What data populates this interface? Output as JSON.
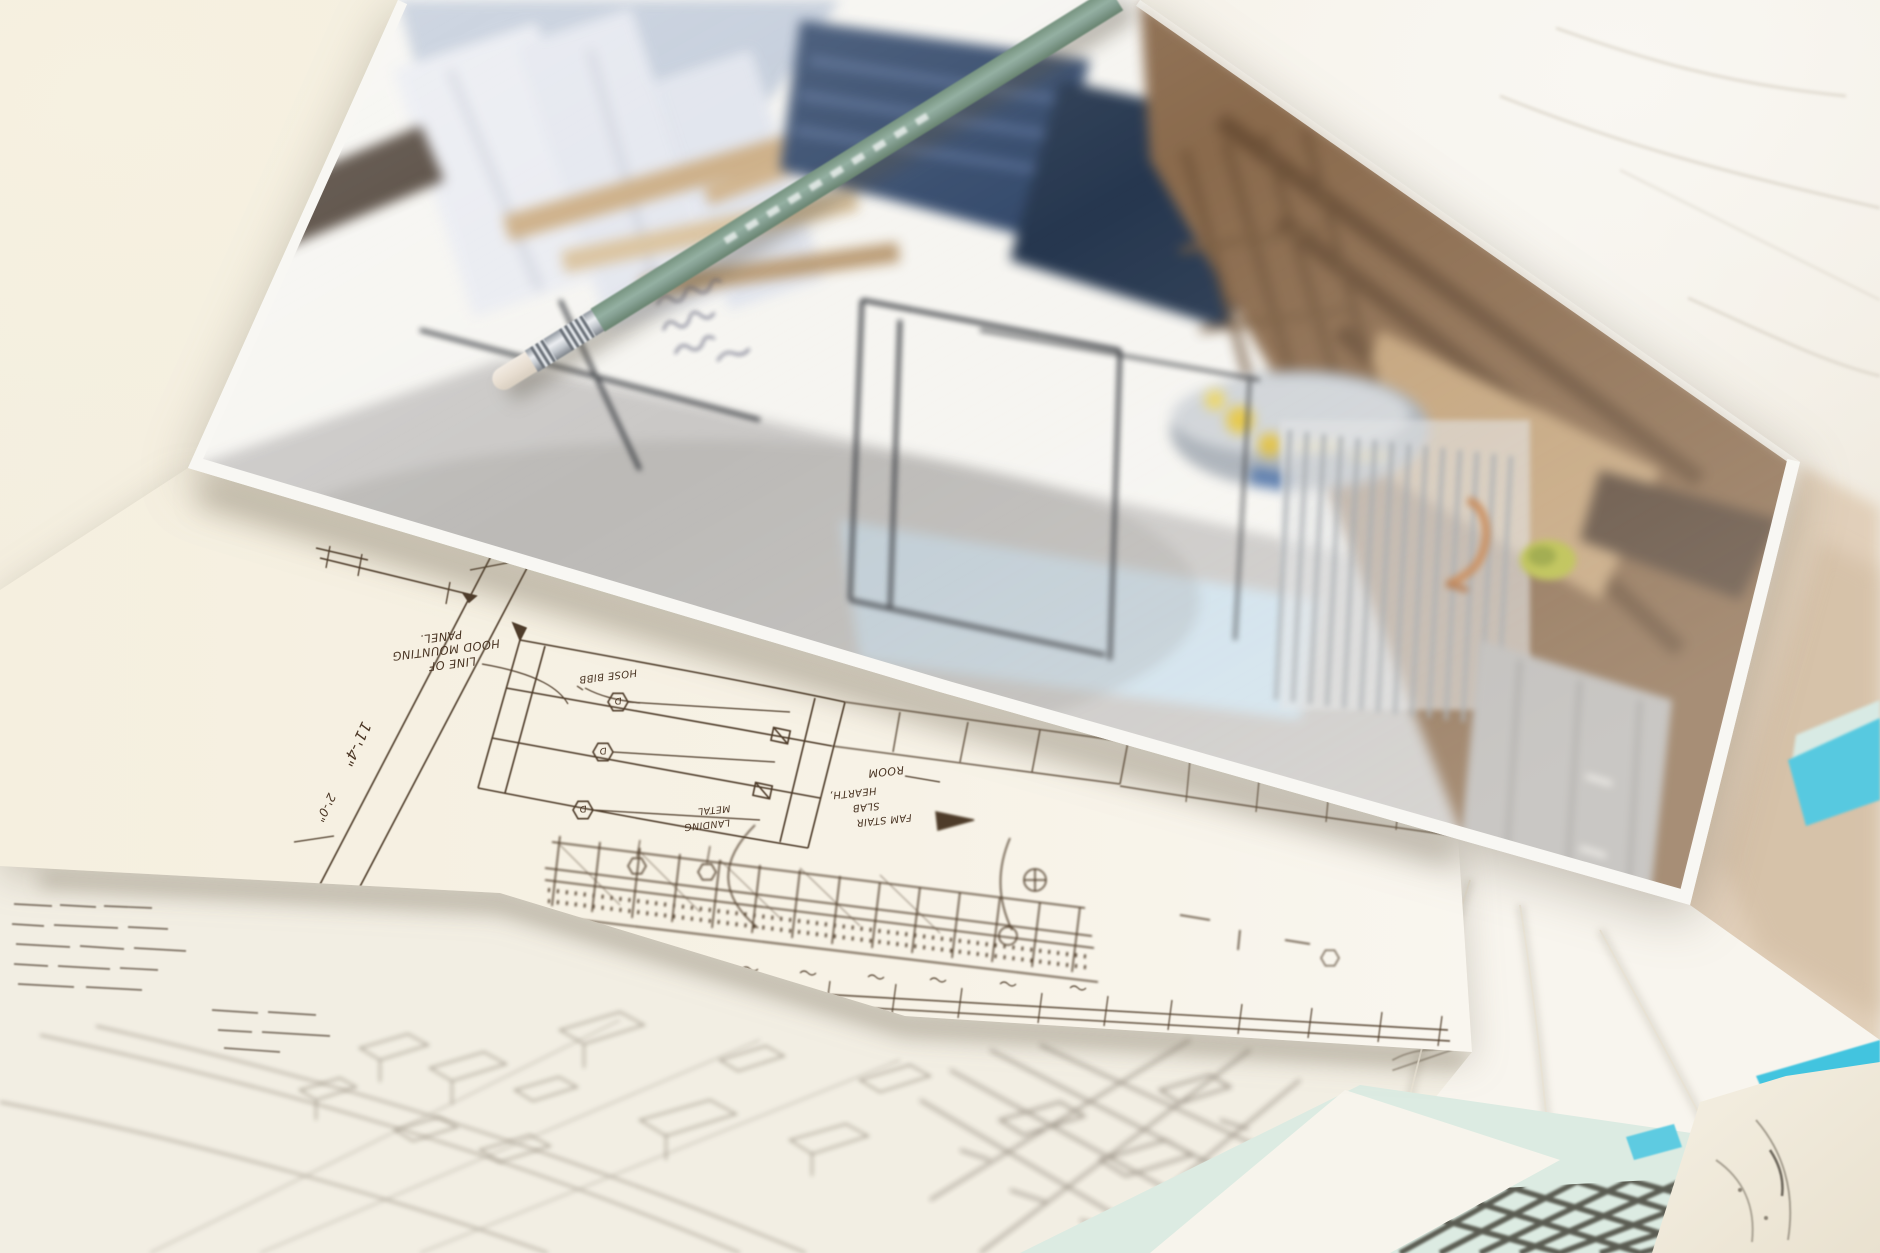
{
  "scene": {
    "title": "Architectural sketches, interior rendering print and pencil on a marble tabletop",
    "objects": [
      "blurred interior rendering print",
      "sage green pencil with silver ferrule and white eraser",
      "hand-drawn kitchen hood elevation sketch in sepia ink",
      "faint pencil axonometric site sketch",
      "mint notebook cover with cross-hatch drawing",
      "cyan notebook edge stripes",
      "marble patterned paper"
    ]
  },
  "colors": {
    "marble": "#f4efe3",
    "marble_beige": "#d9c6b0",
    "sketch_ink": "#4a3524",
    "site_pencil": "#a29a8c",
    "pencil_body": "#84a094",
    "mint_cover": "#dcebe2",
    "cyan_edge": "#42c4df",
    "photo_floor": "#cac8c6",
    "photo_wood": "#8a6a4c",
    "photo_navy": "#33496b",
    "photo_blue": "#cfe3ef"
  },
  "elevation_sketch": {
    "annotations": {
      "dim_a": "11'-4\"",
      "dim_b": "2'-0\"",
      "note_line1": "LINE OF",
      "note_line2": "HOOD MOUNTING",
      "note_line3": "PANEL.",
      "hose_bibb": "HOSE BIBB",
      "room": "ROOM",
      "hearth": "HEARTH,",
      "slab": "SLAB",
      "fam_stair": "FAM STAIR",
      "metal": "METAL",
      "landing": "LANDING",
      "marker_letter": "D"
    }
  }
}
